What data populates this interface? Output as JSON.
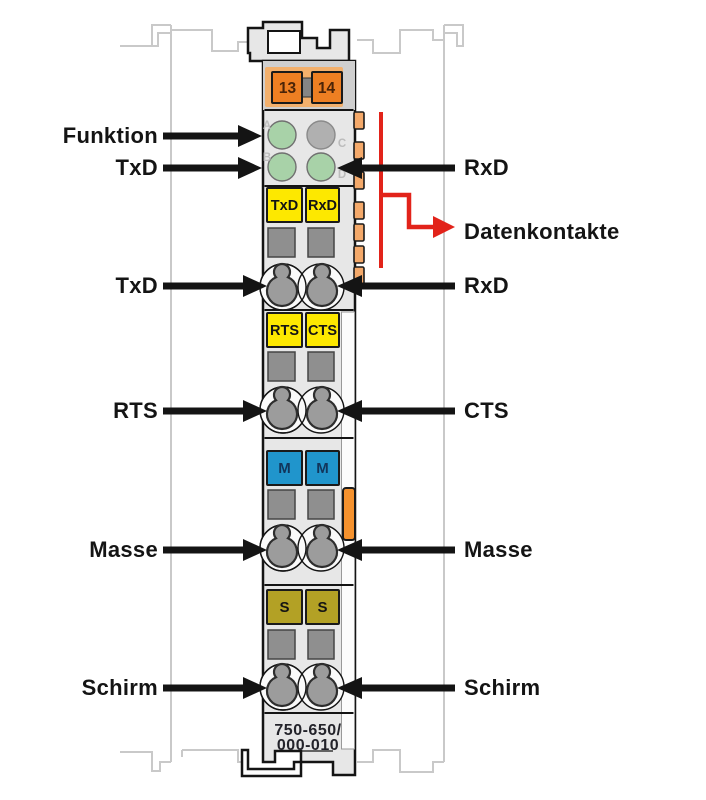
{
  "figure": {
    "part_number_line1": "750-650/",
    "part_number_line2": "000-010"
  },
  "module": {
    "power_terminals": [
      "13",
      "14"
    ],
    "led_letters": [
      "A",
      "B",
      "C",
      "D"
    ],
    "plate_rows": [
      {
        "left": "TxD",
        "right": "RxD"
      },
      {
        "left": "RTS",
        "right": "CTS"
      },
      {
        "left": "M",
        "right": "M"
      },
      {
        "left": "S",
        "right": "S"
      }
    ]
  },
  "callouts": {
    "left": [
      "Funktion",
      "TxD",
      "TxD",
      "RTS",
      "Masse",
      "Schirm"
    ],
    "right": [
      "RxD",
      "RxD",
      "CTS",
      "Masse",
      "Schirm"
    ],
    "data_contacts": "Datenkontakte"
  },
  "colors": {
    "body_gray": "#e7e7e7",
    "strip_gray": "#cfcfcf",
    "terminal_orange": "#ee7f22",
    "frame_orange": "#f3b06c",
    "contact_orange": "#f4a96a",
    "latch_orange": "#f5922e",
    "label_yellow": "#fde800",
    "label_blue": "#2095cc",
    "label_olive": "#b3a125",
    "led_green": "#a8d2a8",
    "led_gray": "#b0b0b0",
    "callout_red": "#e2231a",
    "arrow_black": "#141414"
  }
}
